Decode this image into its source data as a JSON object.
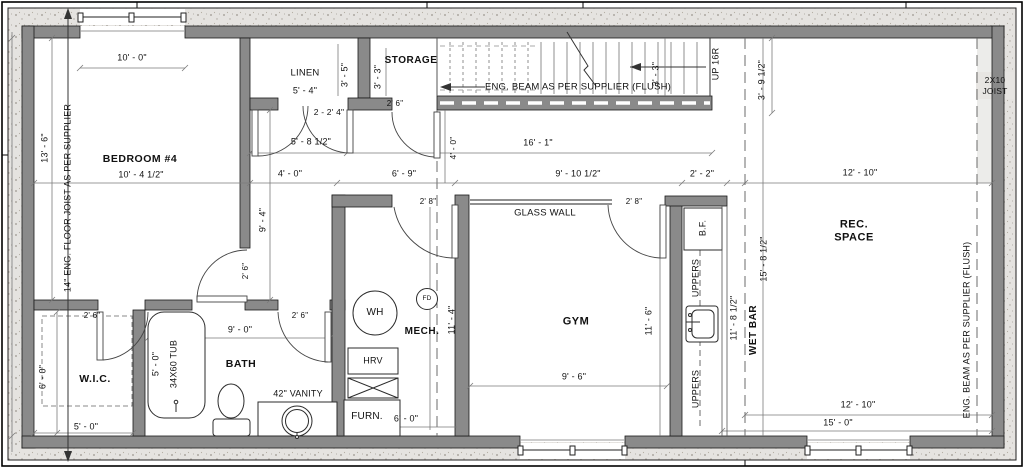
{
  "colors": {
    "wall_gray": "#8a8a8a",
    "concrete": "#e5e3e0",
    "line": "#444444",
    "text": "#111111"
  },
  "rooms": {
    "bedroom": "BEDROOM #4",
    "linen": "LINEN",
    "storage": "STORAGE",
    "wic": "W.I.C.",
    "bath": "BATH",
    "mech": "MECH.",
    "gym": "GYM",
    "rec_line1": "REC.",
    "rec_line2": "SPACE",
    "wet_bar": "WET BAR"
  },
  "annotations": {
    "eng_beam_stairs": "ENG. BEAM AS PER SUPPLIER (FLUSH)",
    "eng_beam_right": "ENG. BEAM AS PER SUPPLIER (FLUSH)",
    "floor_joist_left": "14\" ENG. FLOOR JOIST AS PER SUPPLIER",
    "joist_2x10_line1": "2X10",
    "joist_2x10_line2": "JOIST",
    "up_stairs": "UP 16R",
    "glass_wall": "GLASS WALL",
    "vanity": "42\" VANITY",
    "tub": "34X60 TUB",
    "bf": "B.F.",
    "uppers_top": "UPPERS",
    "uppers_bottom": "UPPERS",
    "wh": "WH",
    "fd": "FD",
    "hrv": "HRV",
    "furn": "FURN."
  },
  "dims": {
    "bedroom_window": "10' - 0\"",
    "bedroom_width": "10' - 4 1/2\"",
    "bedroom_height": "13' - 6\"",
    "linen_width": "5' - 4\"",
    "linen_depth": "3' - 5\"",
    "storage_depth": "3' - 3\"",
    "stairs_width": "3' - 3\"",
    "stairs_offset": "3' - 9 1/2\"",
    "hall_opening": "5' - 8 1/2\"",
    "double_door": "2 - 2' 4\"",
    "hall_16": "16' - 1\"",
    "hall_width": "4' - 0\"",
    "hall_depth": "4' - 0\"",
    "hall_6_9": "6' - 9\"",
    "hall_9_4": "9' - 4\"",
    "gym_width_top": "9' - 10 1/2\"",
    "wetbar_width_top": "2' - 2\"",
    "rec_width_top": "12' - 10\"",
    "storage_door": "2' 6\"",
    "bedroom_door": "2' 6\"",
    "wic_door": "2' 6\"",
    "bath_door": "2' 6\"",
    "mech_door": "2' 8\"",
    "gym_door": "2' 8\"",
    "mech_height": "11' - 4\"",
    "gym_height": "11' - 6\"",
    "gym_width": "9' - 6\"",
    "bath_width": "9' - 0\"",
    "tub_length": "5' - 0\"",
    "wic_height": "6' - 0\"",
    "wic_width": "5' - 0\"",
    "furn_width": "6' - 0\"",
    "wetbar_height": "11' - 8 1/2\"",
    "wetbar_full_height": "15' - 8 1/2\"",
    "rec_width_bottom": "12' - 10\"",
    "rec_full_width": "15' - 0\""
  }
}
